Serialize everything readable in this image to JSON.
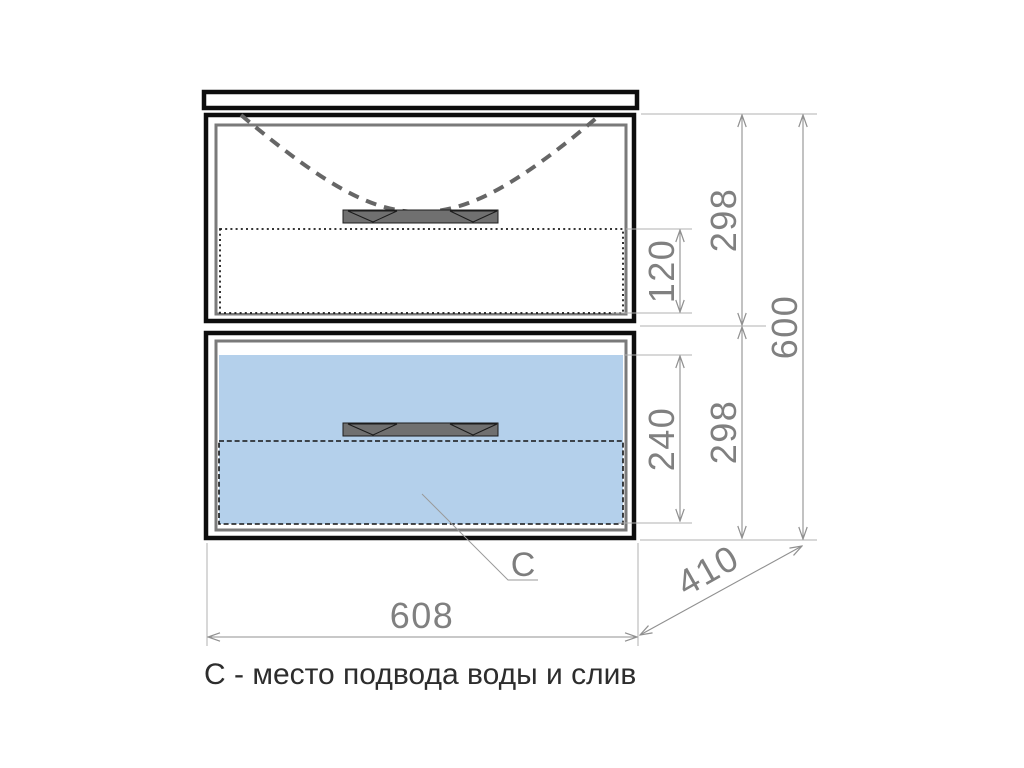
{
  "drawing": {
    "type": "bathroom-vanity-front-elevation",
    "caption": "С - место подвода воды и слив",
    "leader_label": "C",
    "dimensions": {
      "overall_width": "608",
      "overall_height": "600",
      "depth": "410",
      "top_drawer_height": "298",
      "bottom_drawer_height": "298",
      "top_inner_clearance": "120",
      "bottom_inner_clearance": "240"
    },
    "colors": {
      "cabinet_outline": "#0d0d0d",
      "drawer_front": "#7a7a7a",
      "plumbing_zone_fill": "#b4d0eb",
      "handle_fill": "#707070",
      "sink_outline": "#666666",
      "dimension_line": "#909090",
      "extension_line": "#b0b0b0",
      "dimension_text": "#808080",
      "caption_text": "#2d2d2d"
    }
  }
}
